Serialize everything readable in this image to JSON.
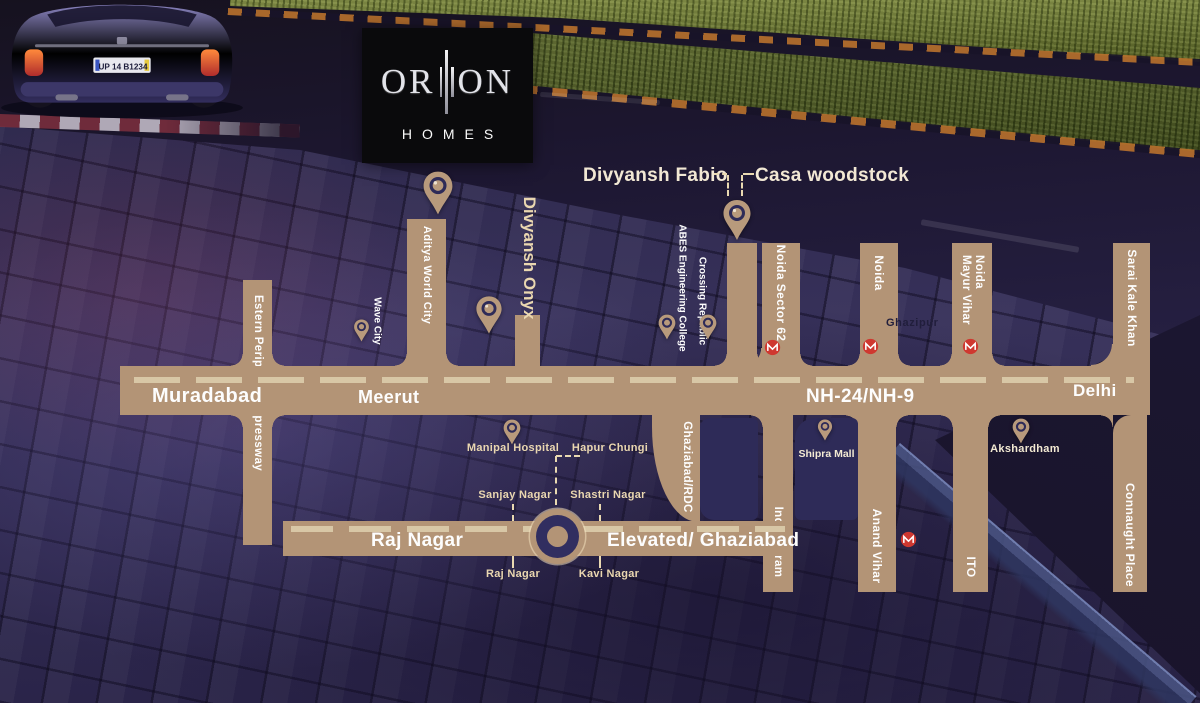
{
  "brand": {
    "logo_left": "OR",
    "logo_right": "ON",
    "logo_sub": "HOMES"
  },
  "scene": {
    "car_plate": "UP 14 B1234"
  },
  "callouts": {
    "divyansh_fabio": "Divyansh Fabio",
    "casa_woodstock": "Casa woodstock",
    "divyansh_onyx": "Divyansh Onyx"
  },
  "highway": {
    "muradabad": "Muradabad",
    "meerut": "Meerut",
    "name": "NH-24/NH-9",
    "delhi": "Delhi"
  },
  "roads": {
    "epe": "Estern Peripheral Expressway",
    "aditya": "Aditya World City",
    "sector62": "Noida Sector 62",
    "noida": "Noida",
    "mayur_line1": "Noida",
    "mayur_line2": "Mayur Vihar",
    "sarai": "Sarai Kale Khan",
    "ghaziabad_rdc": "Ghaziabad/RDC",
    "indirapuram": "Indirapuram",
    "anand": "Anand Vihar",
    "ito": "ITO",
    "connaught": "Connaught Place",
    "raj_nagar": "Raj Nagar",
    "elevated": "Elevated/ Ghaziabad"
  },
  "pois": {
    "wave_city": "Wave City",
    "abes": "ABES Engineering College",
    "crossing_republic": "Crossing Republic",
    "manipal": "Manipal  Hospital",
    "hapur": "Hapur Chungi",
    "sanjay": "Sanjay Nagar",
    "shastri": "Shastri Nagar",
    "raj_nagar_point": "Raj Nagar",
    "kavi": "Kavi Nagar",
    "shipra": "Shipra Mall",
    "akshardham": "Akshardham",
    "ghazipur": "Ghazipur"
  },
  "colors": {
    "road_tan": "#b39476",
    "navy_block": "#2e2b58",
    "dash_cream": "#d8c7a6",
    "label_cream": "#f0e4c6",
    "metro_red": "#cf3830",
    "logo_bg": "#0a0a0c"
  }
}
